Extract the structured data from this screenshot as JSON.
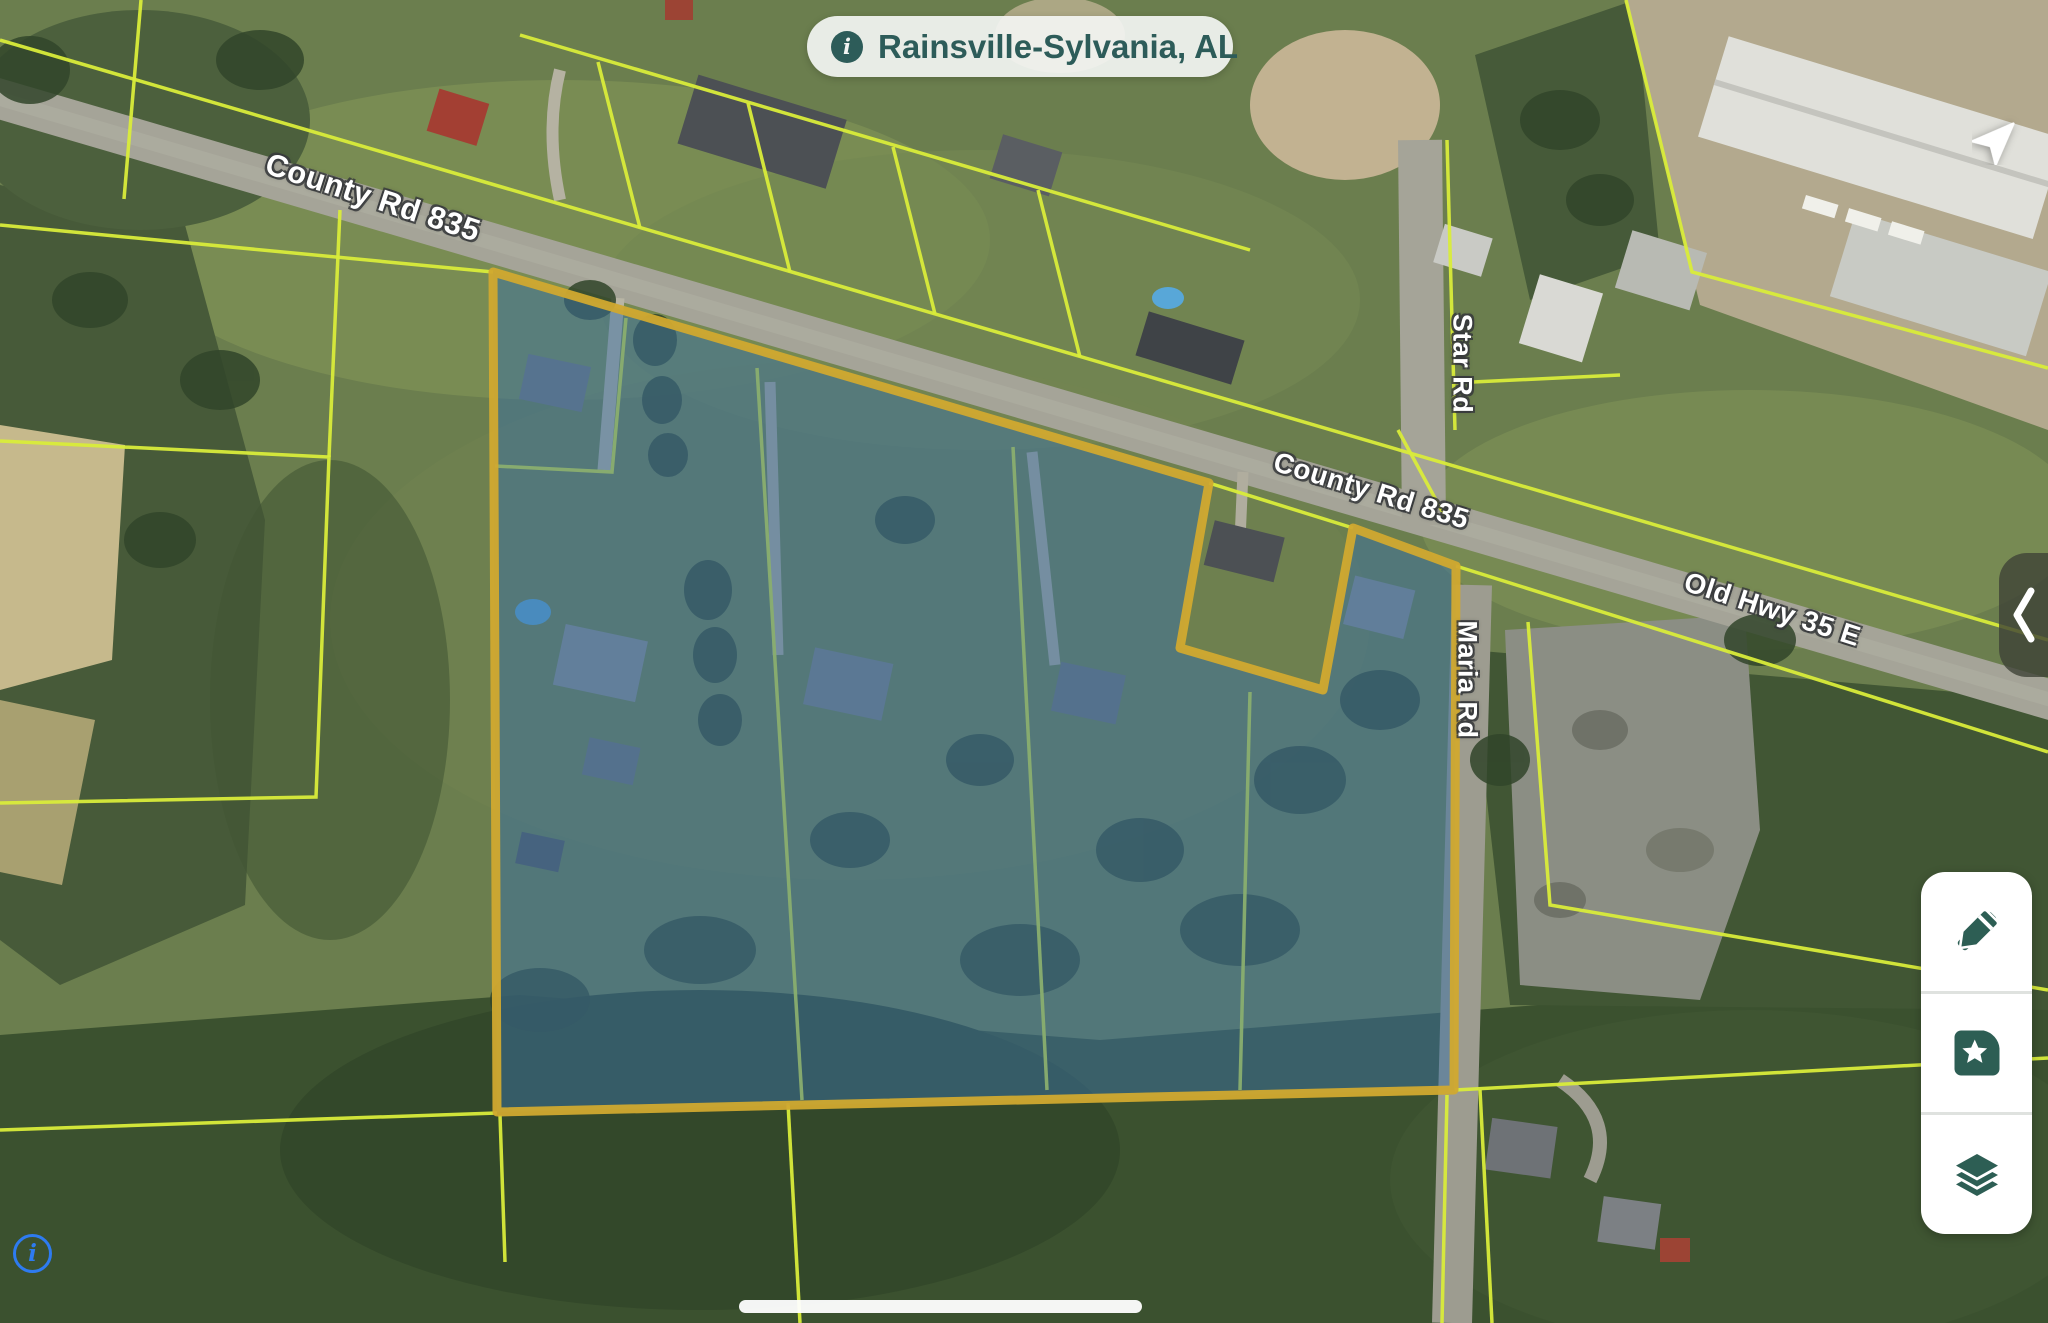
{
  "location_pill": {
    "label": "Rainsville-Sylvania, AL",
    "icon": "info-icon"
  },
  "road_labels": {
    "county_rd_835_upper": "County Rd 835",
    "county_rd_835_lower": "County Rd 835",
    "star_rd": "Star Rd",
    "old_hwy_35_e": "Old Hwy 35 E",
    "maria_rd": "Maria Rd"
  },
  "controls": {
    "locate": "navigation-arrow-icon",
    "panel_toggle": "chevron-left-icon",
    "tool_buttons": [
      "draw-parcel-icon",
      "saved-places-icon",
      "map-layers-icon"
    ],
    "bottom_left": "info-outline-icon",
    "bottom_center": "home-indicator"
  },
  "colors": {
    "parcel_line": "#d9ec3a",
    "selected_parcel_border": "#d1a92f",
    "selected_parcel_fill": "#3a6fa3",
    "pill_text": "#2d5c59",
    "tool_icon": "#2d5e54",
    "info_blue": "#2e7bf0",
    "label_text": "#ffffff"
  }
}
